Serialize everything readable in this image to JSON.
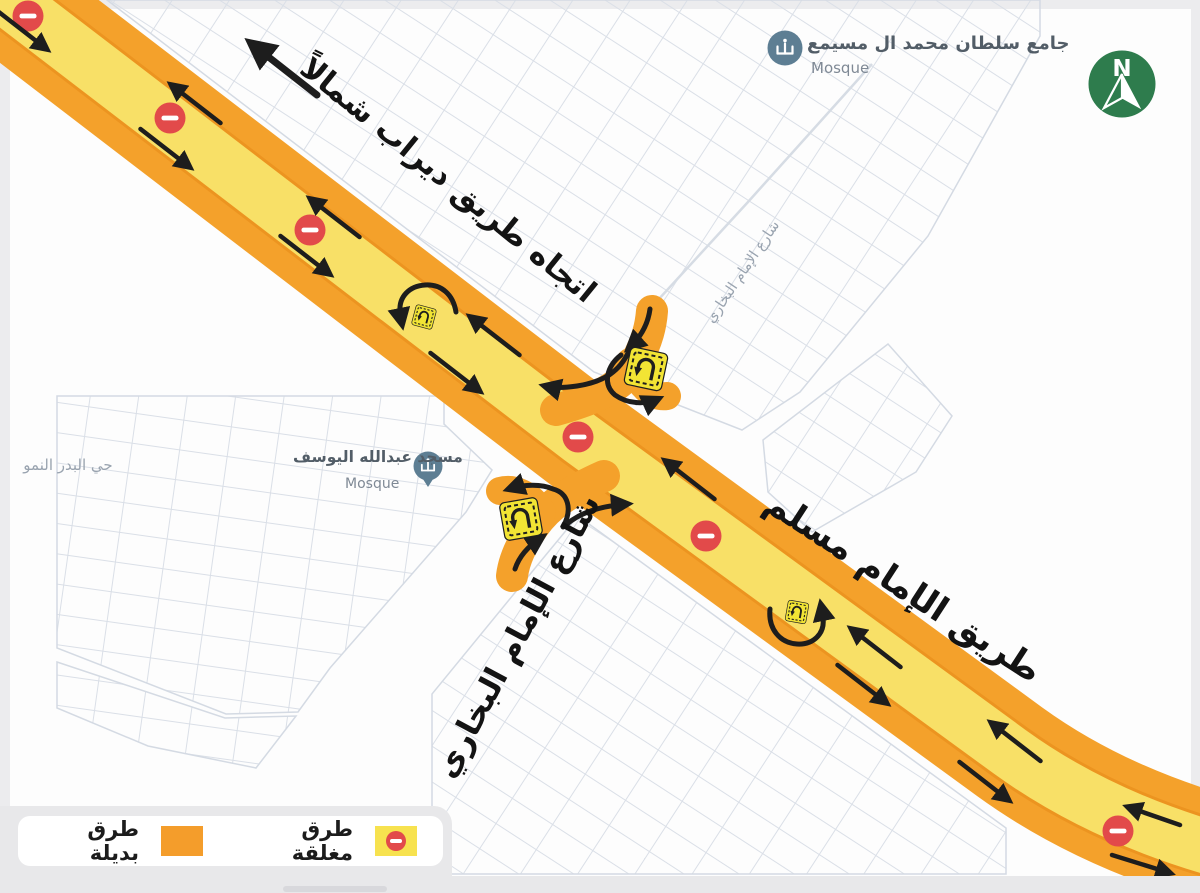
{
  "map": {
    "direction_label": "اتجاه طريق ديراب شمالاً",
    "road_muslim": "طريق الإمام مسلم",
    "street_bukhari": "شارع الإمام البخاري",
    "street_bukhari_minor": "شارع الإمام البخاري",
    "district": "حي البدر النمو",
    "north_letter": "N",
    "mosque_north": {
      "name": "جامع سلطان محمد ال مسيمع",
      "type": "Mosque"
    },
    "mosque_south": {
      "name": "مسجد عبدالله اليوسف",
      "type": "Mosque"
    }
  },
  "legend": {
    "closed": "طرق مغلقة",
    "alternative": "طرق بديلة"
  },
  "colors": {
    "road_alternative_orange": "#F4A12B",
    "road_closed_yellow": "#F8E067",
    "no_entry_red": "#E24A4A",
    "uturn_sign_yellow": "#F2E434",
    "north_badge_green": "#2E7C4D",
    "mosque_icon_blue": "#5D7E93",
    "arrow_black": "#1d1d1d"
  }
}
